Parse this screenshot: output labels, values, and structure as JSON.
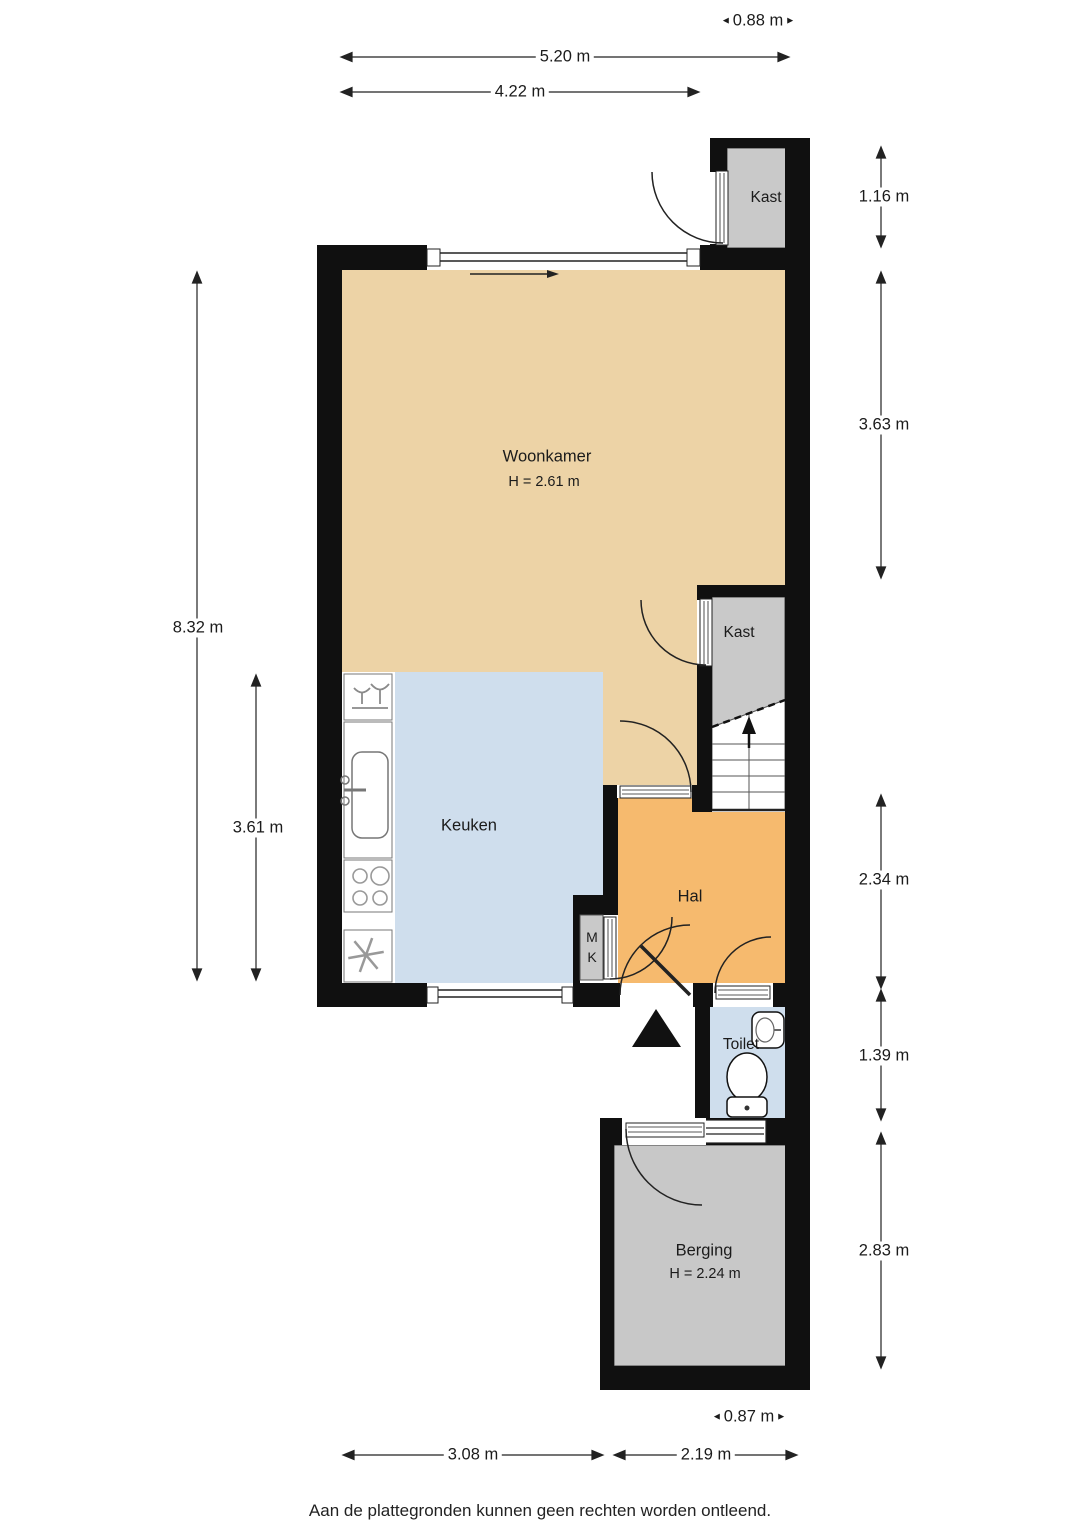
{
  "page": {
    "footer": "Aan de plattegronden kunnen geen rechten worden ontleend."
  },
  "icons": {
    "dim_left": "◄",
    "dim_right": "►"
  },
  "rooms": {
    "woonkamer": {
      "label": "Woonkamer",
      "height": "H = 2.61 m"
    },
    "keuken": {
      "label": "Keuken"
    },
    "hal": {
      "label": "Hal"
    },
    "kast_top": {
      "label": "Kast"
    },
    "kast_mid": {
      "label": "Kast"
    },
    "mk": {
      "line1": "M",
      "line2": "K"
    },
    "toilet": {
      "label": "Toilet"
    },
    "berging": {
      "label": "Berging",
      "height": "H = 2.24 m"
    }
  },
  "dims": {
    "top_kast_width": "0.88 m",
    "top_total_width": "5.20 m",
    "top_inner_width": "4.22 m",
    "left_total_height": "8.32 m",
    "left_keuken_height": "3.61 m",
    "right_kast_height": "1.16 m",
    "right_woonkamer_height": "3.63 m",
    "right_hal_height": "2.34 m",
    "right_toilet_height": "1.39 m",
    "right_berging_height": "2.83 m",
    "bottom_keuken_width": "3.08 m",
    "bottom_berging_width": "2.19 m",
    "bottom_toilet_width": "0.87 m"
  },
  "colors": {
    "wall": "#101010",
    "woonkamer": "#edd3a6",
    "hal": "#f6ba6e",
    "keuken": "#cfdeed",
    "toilet": "#cfdeed",
    "closet": "#c9c9c9",
    "berging": "#c8c8c8"
  }
}
